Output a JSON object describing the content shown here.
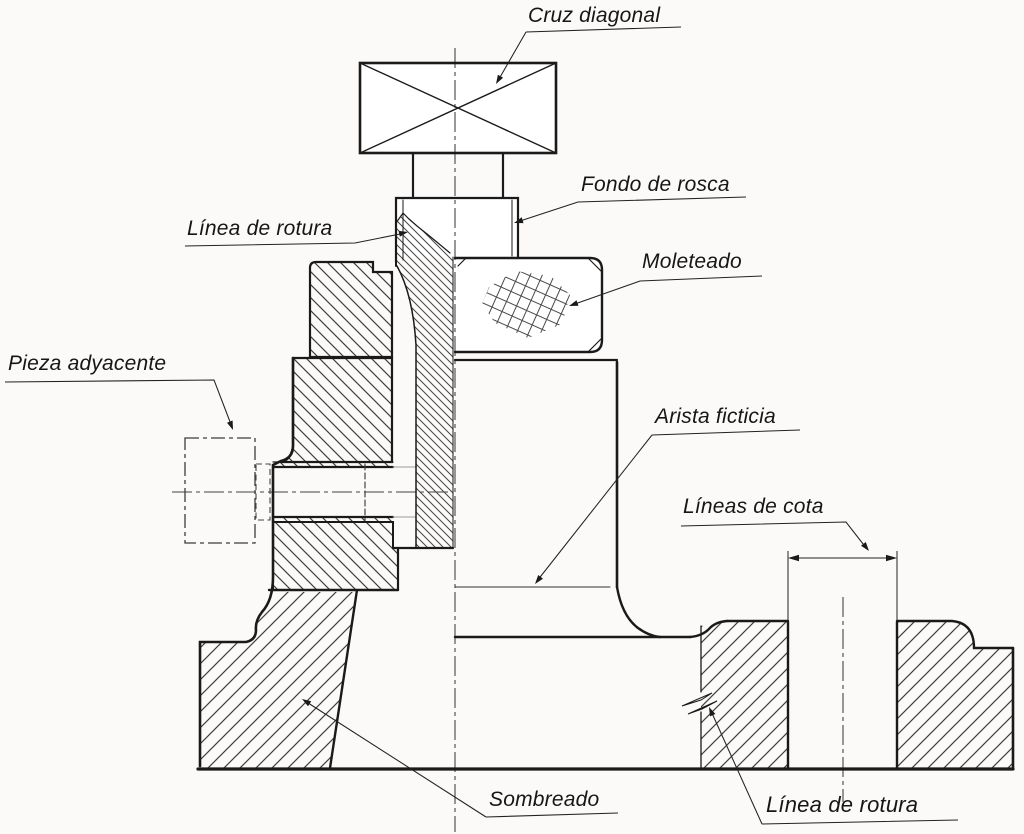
{
  "drawing": {
    "background": "#fbfaf8",
    "line_color": "#1a1a1a",
    "hatch_color": "#3f3f3f",
    "centerline_color": "#444444"
  },
  "labels": {
    "cruz_diagonal": "Cruz diagonal",
    "fondo_de_rosca": "Fondo de rosca",
    "linea_de_rotura_top": "Línea de rotura",
    "moleteado": "Moleteado",
    "pieza_adyacente": "Pieza adyacente",
    "arista_ficticia": "Arista ficticia",
    "lineas_de_cota": "Líneas de cota",
    "sombreado": "Sombreado",
    "linea_de_rotura_bottom": "Línea de rotura"
  }
}
